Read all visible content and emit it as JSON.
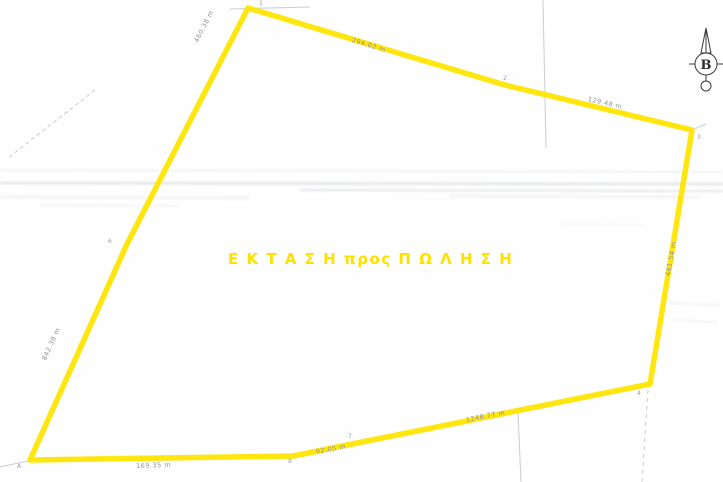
{
  "title": {
    "sale_text": "Ε Κ Τ Α Σ Η  προς Π Ω Λ Η Σ Η",
    "sale_text_color": "#ffe100"
  },
  "parcel": {
    "points_attr": "248,8 505,85 692,130 650,384 352,444 293,456 30,460 127,244",
    "highlight_color": "#ffe60e",
    "underline_color": "#a8adb3",
    "edge_labels": [
      {
        "edge": "1-6",
        "text": "460.38 m"
      },
      {
        "edge": "1-2",
        "text": "294.02 m"
      },
      {
        "edge": "2-3",
        "text": "129.48 m"
      },
      {
        "edge": "3-4",
        "text": "461.54 m"
      },
      {
        "edge": "4-7",
        "text": "1248.77 m"
      },
      {
        "edge": "7-8",
        "text": "92.05 m"
      },
      {
        "edge": "8-A",
        "text": "169.35 m"
      },
      {
        "edge": "6-A",
        "text": "842.38 m"
      }
    ],
    "vertices": [
      {
        "label": "1"
      },
      {
        "label": "2"
      },
      {
        "label": "3"
      },
      {
        "label": "4"
      },
      {
        "label": "6"
      },
      {
        "label": "7"
      },
      {
        "label": "8"
      },
      {
        "label": "A"
      }
    ]
  },
  "north_arrow": {
    "label": "B"
  }
}
